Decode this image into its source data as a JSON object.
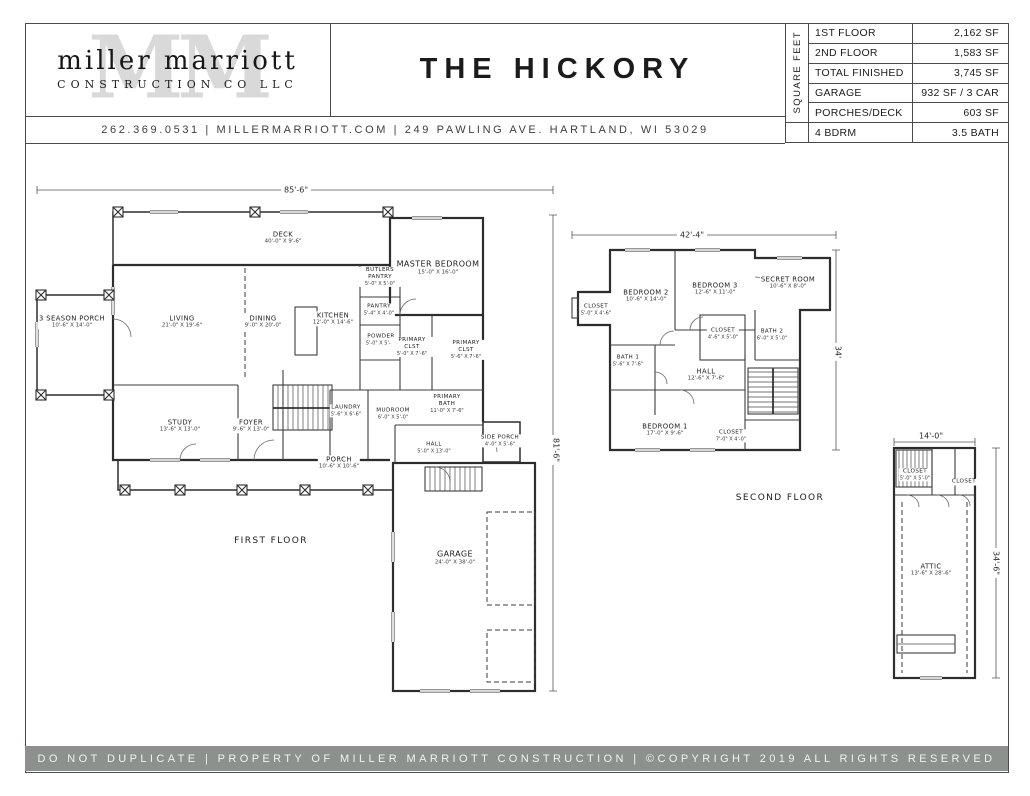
{
  "header": {
    "logo": {
      "watermark": "MM",
      "name": "miller marriott",
      "subtitle": "CONSTRUCTION CO LLC"
    },
    "title": "THE HICKORY",
    "contact": "262.369.0531  |  MILLERMARRIOTT.COM   |   249 PAWLING AVE. HARTLAND, WI 53029",
    "spec_table": {
      "side_label": "SQUARE FEET",
      "rows": [
        {
          "label": "1ST FLOOR",
          "value": "2,162 SF"
        },
        {
          "label": "2ND FLOOR",
          "value": "1,583 SF"
        },
        {
          "label": "TOTAL FINISHED",
          "value": "3,745 SF"
        },
        {
          "label": "GARAGE",
          "value": "932 SF / 3 CAR"
        },
        {
          "label": "PORCHES/DECK",
          "value": "603 SF"
        },
        {
          "label": "4 BDRM",
          "value": "3.5 BATH"
        }
      ]
    }
  },
  "first_floor": {
    "caption": "FIRST FLOOR",
    "width_dim": "85'-6\"",
    "height_dim": "81'-6\"",
    "rooms": [
      {
        "name": "DECK",
        "size": "40'-0\" X 9'-6\""
      },
      {
        "name": "MASTER BEDROOM",
        "size": "15'-0\" X 16'-0\""
      },
      {
        "name": "3 SEASON PORCH",
        "size": "10'-6\" X 14'-0\""
      },
      {
        "name": "LIVING",
        "size": "21'-0\" X 19'-6\""
      },
      {
        "name": "DINING",
        "size": "9'-0\" X 20'-0\""
      },
      {
        "name": "KITCHEN",
        "size": "12'-0\" X 14'-6\""
      },
      {
        "name": "BUTLERS PANTRY",
        "size": "5'-0\" X 5'-0\""
      },
      {
        "name": "PANTRY",
        "size": "5'-4\" X 4'-0\""
      },
      {
        "name": "POWDER",
        "size": "5'-0\" X 5'-6\""
      },
      {
        "name": "PRIMARY CLST",
        "size": "5'-0\" X 7'-6\""
      },
      {
        "name": "PRIMARY CLST",
        "size": "5'-6\" X 7'-6\""
      },
      {
        "name": "STUDY",
        "size": "13'-6\" X 13'-0\""
      },
      {
        "name": "FOYER",
        "size": "9'-6\" X 13'-0\""
      },
      {
        "name": "LAUNDRY",
        "size": "5'-6\" X 6'-6\""
      },
      {
        "name": "MUDROOM",
        "size": "6'-0\" X 5'-0\""
      },
      {
        "name": "PRIMARY BATH",
        "size": "11'-0\" X 7'-6\""
      },
      {
        "name": "HALL",
        "size": "5'-0\" X 13'-0\""
      },
      {
        "name": "SIDE PORCH",
        "size": "4'-0\" X 5'-6\""
      },
      {
        "name": "PORCH",
        "size": "10'-6\" X 10'-6\""
      },
      {
        "name": "GARAGE",
        "size": "24'-0\" X 38'-0\""
      }
    ]
  },
  "second_floor": {
    "caption": "SECOND FLOOR",
    "width_dim": "42'-4\"",
    "height_dim": "34'",
    "rooms": [
      {
        "name": "BEDROOM 2",
        "size": "10'-6\" X 14'-0\""
      },
      {
        "name": "BEDROOM 3",
        "size": "12'-6\" X 11'-0\""
      },
      {
        "name": "SECRET ROOM",
        "size": "10'-6\" X 8'-0\""
      },
      {
        "name": "CLOSET",
        "size": "5'-0\" X 4'-6\""
      },
      {
        "name": "BATH 1",
        "size": "5'-6\" X 7'-6\""
      },
      {
        "name": "CLOSET",
        "size": "4'-6\" X 5'-0\""
      },
      {
        "name": "BATH 2",
        "size": "6'-0\" X 5'-0\""
      },
      {
        "name": "HALL",
        "size": "12'-6\" X 7'-6\""
      },
      {
        "name": "BEDROOM 1",
        "size": "17'-0\" X 9'-6\""
      },
      {
        "name": "CLOSET",
        "size": "7'-0\" X 4'-0\""
      }
    ]
  },
  "attic": {
    "width_dim": "14'-0\"",
    "height_dim": "34'-6\"",
    "rooms": [
      {
        "name": "CLOSET",
        "size": "5'-0\" X 5'-0\""
      },
      {
        "name": "CLOSET",
        "size": ""
      },
      {
        "name": "ATTIC",
        "size": "13'-6\" X 28'-6\""
      }
    ]
  },
  "footer": {
    "text": "DO NOT DUPLICATE | PROPERTY OF MILLER MARRIOTT CONSTRUCTION | ©COPYRIGHT 2019 ALL RIGHTS RESERVED"
  }
}
